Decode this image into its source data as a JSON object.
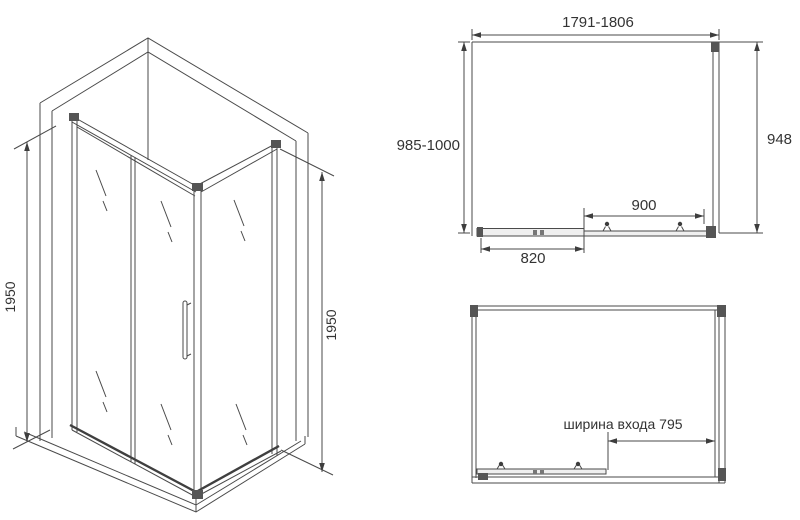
{
  "drawing": {
    "background": "#ffffff",
    "line_color": "#4a4a4a",
    "text_color": "#333333"
  },
  "views": {
    "isometric": {
      "height_left": "1950",
      "height_right": "1950"
    },
    "plan": {
      "overall_width": "1791-1806",
      "overall_depth": "985-1000",
      "side_width": "948",
      "door_span": "900",
      "panel_span": "820"
    },
    "front": {
      "entrance_width": "ширина входа 795"
    }
  }
}
